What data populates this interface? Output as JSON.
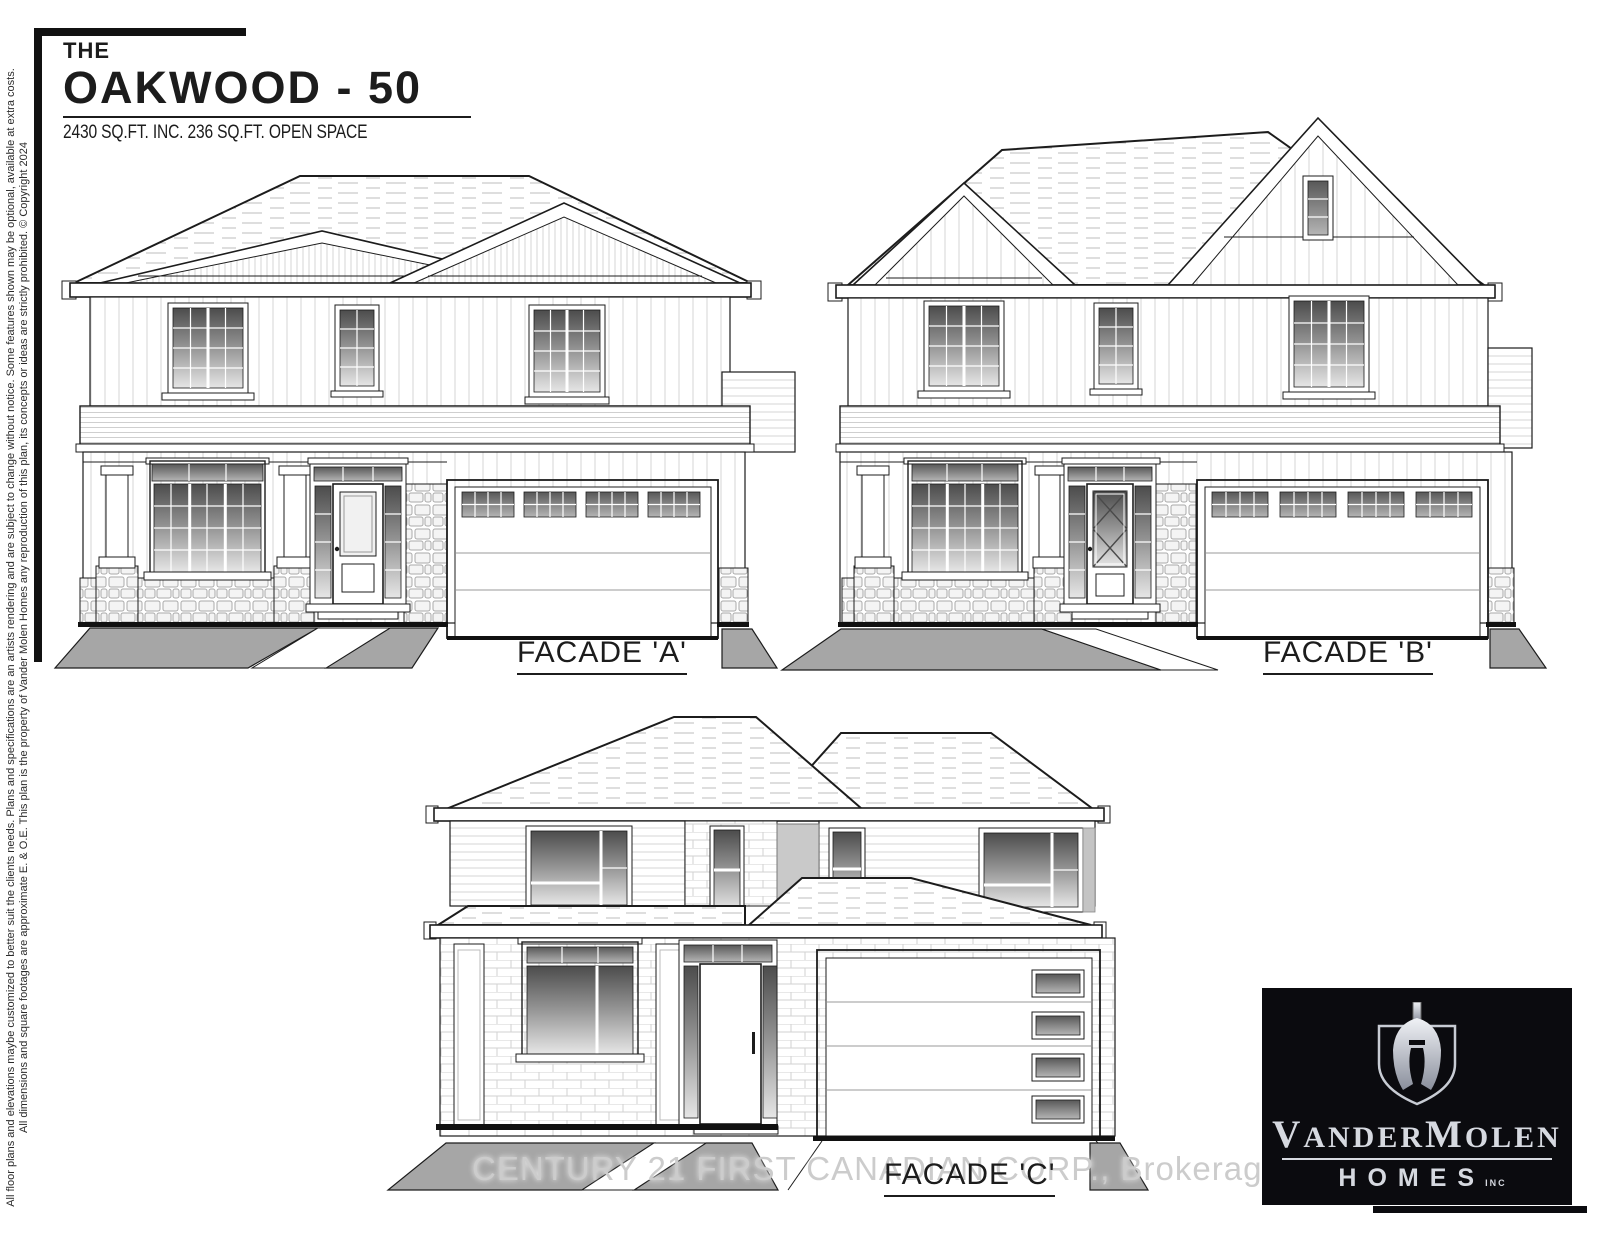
{
  "title": {
    "prefix": "THE",
    "name": "OAKWOOD - 50",
    "subtitle": "2430 SQ.FT. INC. 236 SQ.FT. OPEN SPACE"
  },
  "facade_labels": {
    "a": "FACADE 'A'",
    "b": "FACADE 'B'",
    "c": "FACADE 'C'"
  },
  "watermark": "CENTURY 21 FIRST CANADIAN CORP., Brokerage",
  "disclaimers": {
    "line1": "All floor plans and elevations maybe customized to better suit the clients needs. Plans and specifications are an artists rendering and are subject to change without notice. Some features shown may be optional, available at extra costs.",
    "line2": "All dimensions and square footages are approximate E. & O.E. This plan is the property of Vander Molen Homes any reproduction of this plan, its concepts or ideas are strictly prohibited. © Copyright 2024"
  },
  "logo": {
    "name_parts": {
      "p1": "V",
      "p2": "ANDER",
      "p3": "M",
      "p4": "OLEN"
    },
    "homes": "HOMES",
    "inc": "INC"
  },
  "colors": {
    "ink": "#1c1c1c",
    "driveway_gray": "#a6a6a6",
    "panel_gray": "#c9c9c9",
    "logo_bg": "#0b0b0f",
    "logo_text": "#d6d9e0",
    "watermark_text": "#cccccc"
  }
}
